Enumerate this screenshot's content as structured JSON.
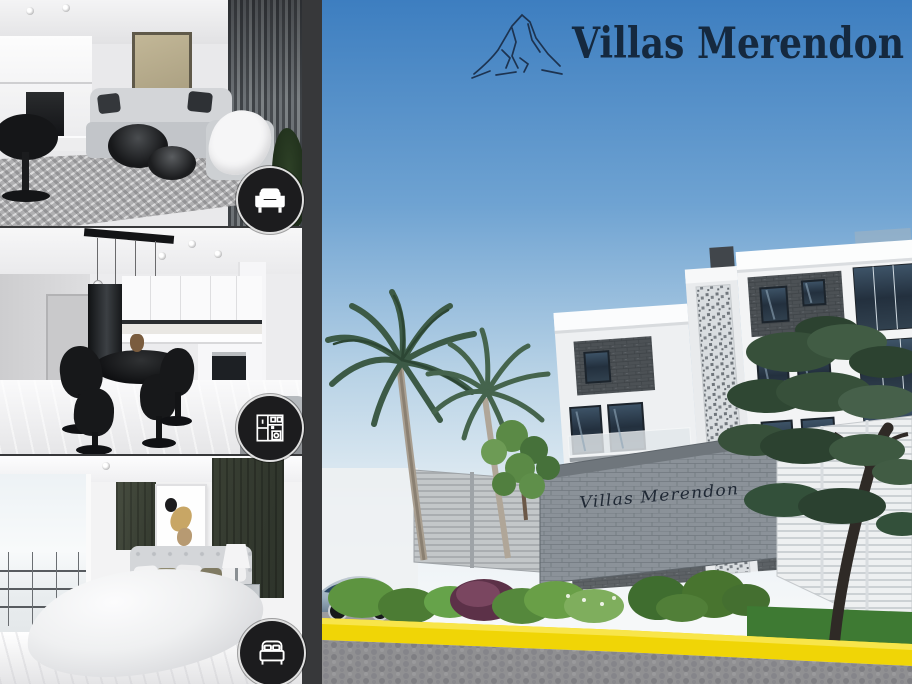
{
  "brand": {
    "name": "Villas Merendon",
    "logo_icon": "mountain-icon",
    "navy": "#15293f"
  },
  "gallery": {
    "photos": [
      {
        "id": "living-room",
        "badge_icon": "sofa-icon"
      },
      {
        "id": "kitchen-dining",
        "badge_icon": "kitchen-cabinets-icon"
      },
      {
        "id": "bedroom",
        "badge_icon": "bed-icon"
      }
    ]
  },
  "scene": {
    "entrance_sign": "Villas Merendon",
    "palette": {
      "sky_top": "#3d7ec0",
      "sky_horizon": "#f4f7f8",
      "curb_yellow": "#f0d506",
      "road_gray": "#8f8f91",
      "building_white": "#f3f4f5",
      "accent_dark_panel": "#4c5155",
      "foliage_dark": "#33503a",
      "foliage_light": "#66a34a",
      "logo_navy": "#15293f"
    }
  }
}
